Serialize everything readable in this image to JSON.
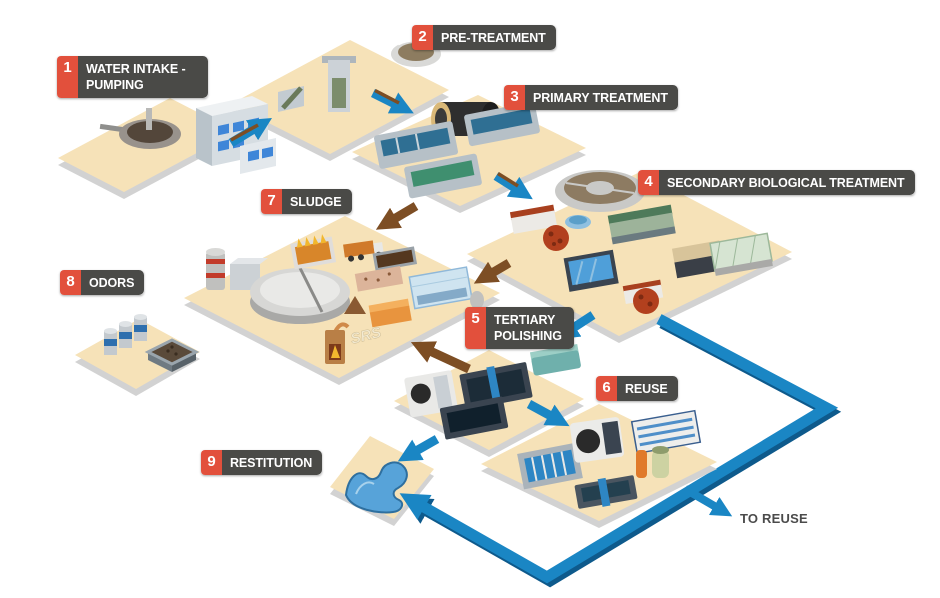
{
  "labels": {
    "steps": [
      {
        "number": "1",
        "text": "WATER INTAKE - PUMPING"
      },
      {
        "number": "2",
        "text": "PRE-TREATMENT"
      },
      {
        "number": "3",
        "text": "PRIMARY TREATMENT"
      },
      {
        "number": "4",
        "text": "SECONDARY BIOLOGICAL TREATMENT"
      },
      {
        "number": "5",
        "text": "TERTIARY POLISHING"
      },
      {
        "number": "6",
        "text": "REUSE"
      },
      {
        "number": "7",
        "text": "SLUDGE"
      },
      {
        "number": "8",
        "text": "ODORS"
      },
      {
        "number": "9",
        "text": "RESTITUTION"
      }
    ],
    "to_reuse": "TO REUSE",
    "watermark": "SRS"
  },
  "colors": {
    "platform": "#f6e2b8",
    "platform_edge": "#d2d2d2",
    "label_background": "#4a4a47",
    "label_number_background": "#e2503c",
    "label_text": "#ffffff",
    "water_flow_arrow": "#1a86c4",
    "sludge_flow_arrow": "#7d4e24",
    "reuse_pipe": "#1a86c4"
  },
  "platforms": [
    {
      "name": "water-intake-pumping",
      "items": [
        "intake-well",
        "pumping-station-building"
      ]
    },
    {
      "name": "pre-treatment",
      "items": [
        "bar-screen",
        "grit-chamber",
        "grease-removal-tank"
      ]
    },
    {
      "name": "primary-treatment",
      "items": [
        "rotary-drum",
        "settling-tank-1",
        "settling-tank-2",
        "settling-tank-3"
      ]
    },
    {
      "name": "secondary-biological-treatment",
      "items": [
        "aeration-tank",
        "dosing-tanks",
        "biofilter-sphere-1",
        "covered-channel",
        "clarifier",
        "technical-building",
        "greenhouse",
        "biofilter-sphere-2",
        "dosing-tank-2"
      ]
    },
    {
      "name": "sludge",
      "items": [
        "storage-silo",
        "buffer-tank",
        "digester",
        "grate-furnace",
        "sludge-truck",
        "drying-bed",
        "composting-bed",
        "sludge-pile",
        "technical-building",
        "incinerator",
        "greenhouse-dryer"
      ]
    },
    {
      "name": "tertiary-polishing",
      "items": [
        "drum-filter",
        "filter-cell-1",
        "filter-cell-2",
        "uv-disinfection-unit"
      ]
    },
    {
      "name": "reuse",
      "items": [
        "filter-bank",
        "drum-screen",
        "membrane-rack",
        "chlorination-column",
        "storage-tank",
        "treatment-channel"
      ]
    },
    {
      "name": "odors",
      "items": [
        "scrubber-tower-1",
        "scrubber-tower-2",
        "scrubber-tower-3",
        "biofilter-bed"
      ]
    },
    {
      "name": "restitution",
      "items": [
        "river"
      ]
    }
  ]
}
